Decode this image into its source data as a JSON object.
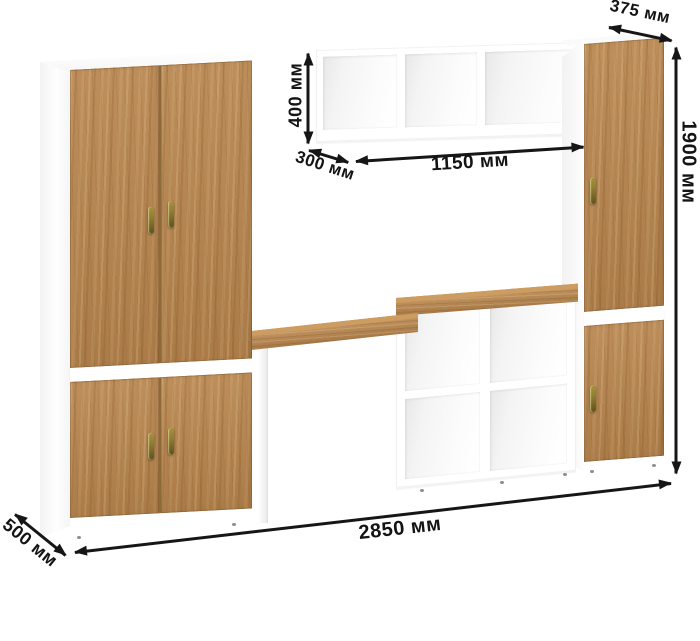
{
  "labels": {
    "depth_top": "375 мм",
    "height": "1900 мм",
    "shelf_height": "400 мм",
    "shelf_depth": "300 мм",
    "shelf_width": "1150 мм",
    "total_width": "2850 мм",
    "depth_bottom": "500 мм"
  },
  "colors": {
    "bg": "#ffffff",
    "wood": "#b8854d",
    "wood_light": "#cd9c60",
    "carcass": "#ffffff",
    "dim": "#161616",
    "handle": "#8f7d33",
    "handle_dark": "#5e511d"
  }
}
